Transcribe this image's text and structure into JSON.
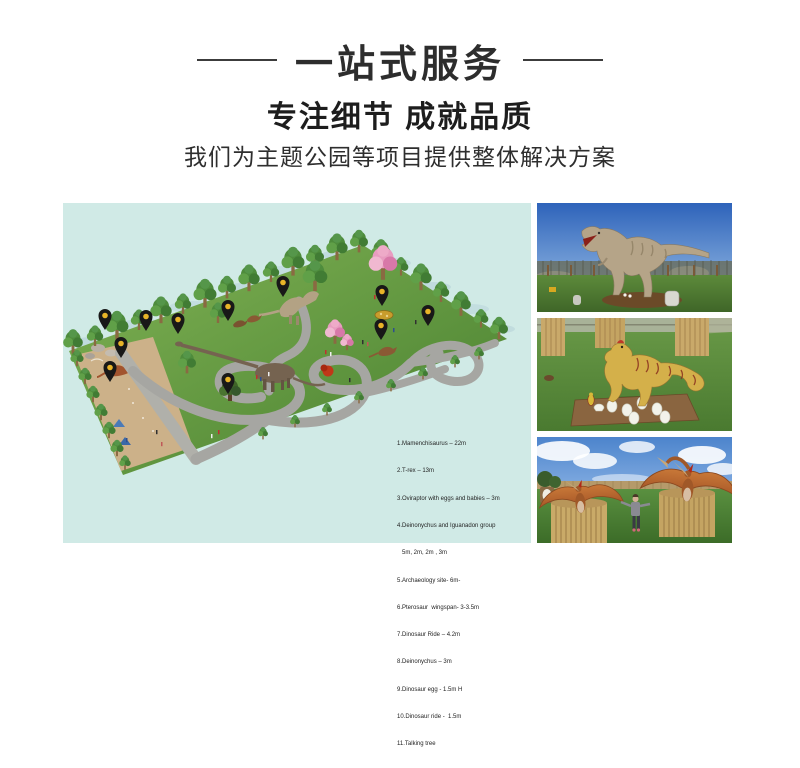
{
  "header": {
    "banner_title": "一站式服务",
    "headline": "专注细节 成就品质",
    "subtitle": "我们为主题公园等项目提供整体解决方案"
  },
  "plan": {
    "background_color": "#d0eae6",
    "pin_color": "#181818",
    "pin_dot_color": "#e8b428",
    "pin_count": 11,
    "legend_lines": [
      "1.Mamenchisaurus – 22m",
      "2.T-rex – 13m",
      "3.Oviraptor with eggs and babies – 3m",
      "4.Deinonychus and Iguanadon group",
      "   5m, 2m, 2m , 3m",
      "5.Archaeology site- 6m-",
      "6.Pterosaur  wingspan- 3-3.5m",
      "7.Dinosaur Ride – 4.2m",
      "8.Deinonychus – 3m",
      "9.Dinosaur egg - 1.5m H",
      "10.Dinosaur ride -  1.5m",
      "11.Talking tree"
    ]
  }
}
